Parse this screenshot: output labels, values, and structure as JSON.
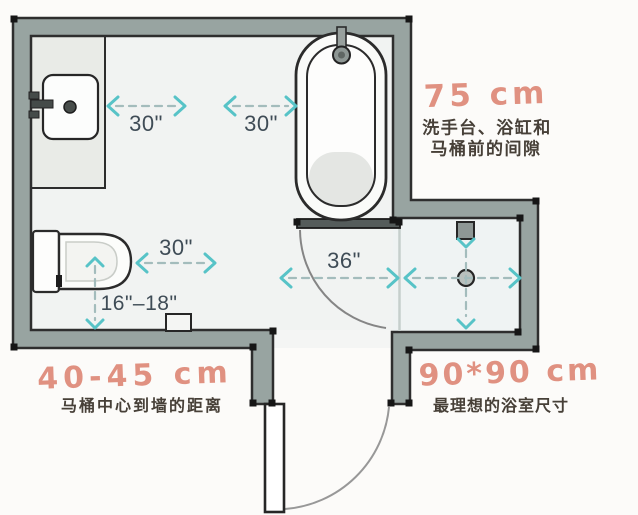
{
  "dimensions": {
    "sink_clearance": "30\"",
    "tub_clearance": "30\"",
    "toilet_clearance": "30\"",
    "toilet_center": "16\"–18\"",
    "doorway": "36\""
  },
  "annotations": {
    "front_clearance_value": "75 cm",
    "front_clearance_line1": "洗手台、浴缸和",
    "front_clearance_line2": "马桶前的间隙",
    "toilet_offset_value": "40-45 cm",
    "toilet_offset_label": "马桶中心到墙的距离",
    "shower_size_value": "90*90 cm",
    "shower_size_label": "最理想的浴室尺寸"
  },
  "colors": {
    "wall_fill": "#98a4a1",
    "wall_outline": "#2e2e2e",
    "floor": "#f1f3f2",
    "arrow_teal": "#57c3c7",
    "arrow_dash": "#a3bcbc",
    "dimension_text": "#3f4c56",
    "annotation_salmon": "#e09181",
    "chinese_text": "#474038"
  }
}
